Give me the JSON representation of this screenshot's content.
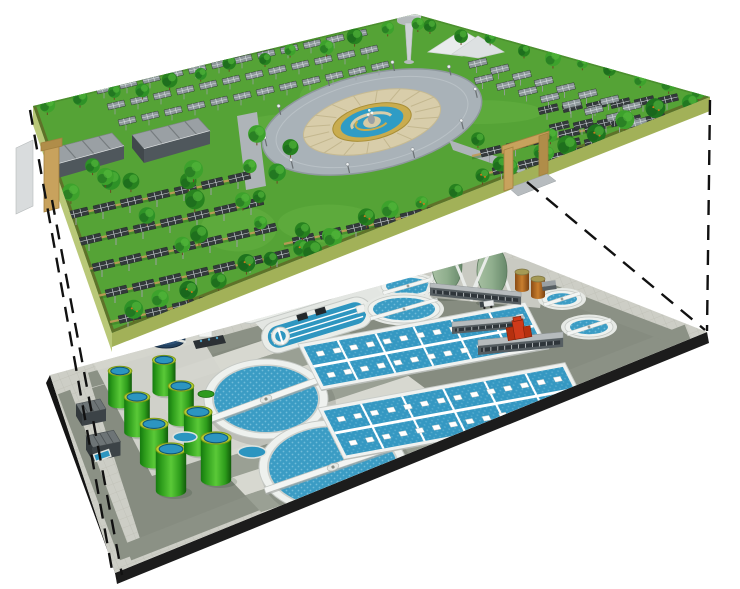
{
  "scene": {
    "description": "Cutaway 3D illustration: rooftop solar park with fountain plaza above an underground wastewater treatment plant",
    "background": "#ffffff",
    "width": 740,
    "height": 589
  },
  "upper_level": {
    "name": "solar-park-deck",
    "grass": "#55a336",
    "grass_light": "#6ab545",
    "edge_band": "#5f7029",
    "back_edge_band": "#47862b",
    "side_wall": "#b9c878",
    "side_wall_right": "#a2b158",
    "ramp": "#d9dcdd",
    "solar_panel_dark": "#33393b",
    "solar_panel_light": "#8d979a",
    "panel_grid": "#d8dee1",
    "panel_post": "#9aa0a2",
    "terrace": "#c09a58",
    "row_shadow": "#2c6b1d",
    "tree_colors": [
      "#1e741e",
      "#2e9227",
      "#3da22c",
      "#27821f"
    ],
    "tree_trunk": "#6b4a22",
    "fruit_dot": "#d07818",
    "plaza": {
      "ring": "#a9b2b8",
      "curb": "#8f989e",
      "tiles": "#d8cdaa",
      "spoke": "#c3b78f",
      "gold_ring": "#c9ac4e",
      "water": "#2f9cc5",
      "fountain_base": "#d6cba6",
      "fountain_rock": "#9aa0a3"
    },
    "road": "#aeb4b8",
    "gate_color": "#c8a25d",
    "gate_dark": "#a3803f",
    "gate_ramp": "#b7bcbf",
    "shed_roof": "#9aa0a4",
    "shed_ridge": "#767c7f",
    "shed_body": "#4f575c",
    "shed_end": "#41484c",
    "tower_color": "#cdd2d4",
    "tower_disc": "#d3d7d9",
    "tent": "#e8ebec",
    "counts": {
      "solar_fields": 6,
      "sheds": 2,
      "gates": 2,
      "towers": 1,
      "trees": 70,
      "plaza_light_posts": 10
    }
  },
  "lower_level": {
    "name": "treatment-plant-floor",
    "pavement": "#cdcec6",
    "pavement_tile": "#b9bab0",
    "inner_area": "#868c80",
    "road": "#8b9185",
    "stripe_light": "#d7d8d0",
    "stripe_dark": "#9aa094",
    "base_edge": "#1c1c1c",
    "pad_light": "#d4d5cd",
    "deck": "#e3e6e2",
    "water": "#3b9cc4",
    "water_dot": "#7cc2dd",
    "clarifier_wall": "#eef1ee",
    "bridge": "#f3f5f3",
    "tank_green_rim": "#b5cc2f",
    "tank_water": "#2c95c0",
    "egg_color": "#8fae8d",
    "egg_frame": "#e8ebe8",
    "orange_tank": "#c97f2e",
    "building_top": "#b6bbbd",
    "building_front": "#565e62",
    "window_strip": "#cfd4d6",
    "dark_building": "#6d7476",
    "dark_building_front": "#3c4347",
    "thickener": "#23415f",
    "red_structure": "#cf3a1a",
    "red_dark": "#b5300f",
    "counts": {
      "green_tanks": 8,
      "egg_digesters": 2,
      "clarifiers_large": 2,
      "clarifiers_medium": 2,
      "clarifiers_small": 2,
      "oxidation_ditches": 2,
      "aeration_basins": 2,
      "orange_tanks": 2,
      "gallery_buildings": 3,
      "service_buildings": 2,
      "sludge_thickeners": 2,
      "red_pump_stations": 1,
      "flare_stacks": 1
    }
  },
  "connectors": {
    "style": "dashed",
    "color": "#111111",
    "count": 4
  }
}
